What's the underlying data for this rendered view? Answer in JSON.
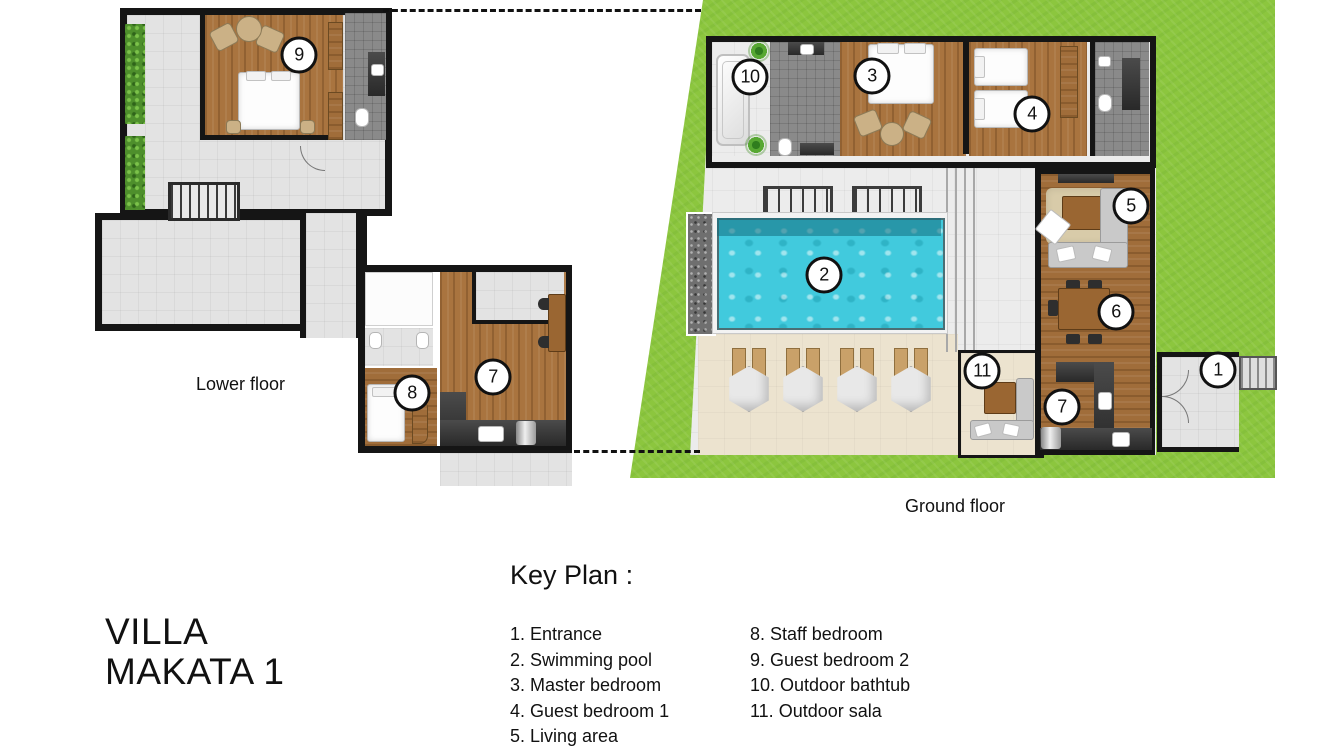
{
  "title": {
    "line1": "VILLA",
    "line2": "MAKATA 1"
  },
  "floors": {
    "lower": {
      "label": "Lower floor"
    },
    "ground": {
      "label": "Ground floor"
    }
  },
  "key_plan": {
    "heading": "Key Plan :",
    "column1": [
      "1. Entrance",
      "2. Swimming pool",
      "3. Master bedroom",
      "4. Guest bedroom 1",
      "5. Living area"
    ],
    "column2": [
      "8. Staff bedroom",
      "9. Guest bedroom 2",
      "10. Outdoor bathtub",
      "11. Outdoor sala"
    ]
  },
  "markers": {
    "entrance": "1",
    "swimming_pool": "2",
    "master_bedroom": "3",
    "guest_bedroom_1": "4",
    "living_area": "5",
    "dining_area": "6",
    "kitchen_ground": "7",
    "kitchen_lower": "7",
    "staff_bedroom": "8",
    "guest_bedroom_2": "9",
    "outdoor_bathtub": "10",
    "outdoor_sala": "11"
  },
  "colors": {
    "grass": "#8cc63e",
    "pool_water": "#41cadd",
    "wood_floor": "#a9743f",
    "sun_deck": "#ece3cf",
    "wall": "#151515"
  }
}
